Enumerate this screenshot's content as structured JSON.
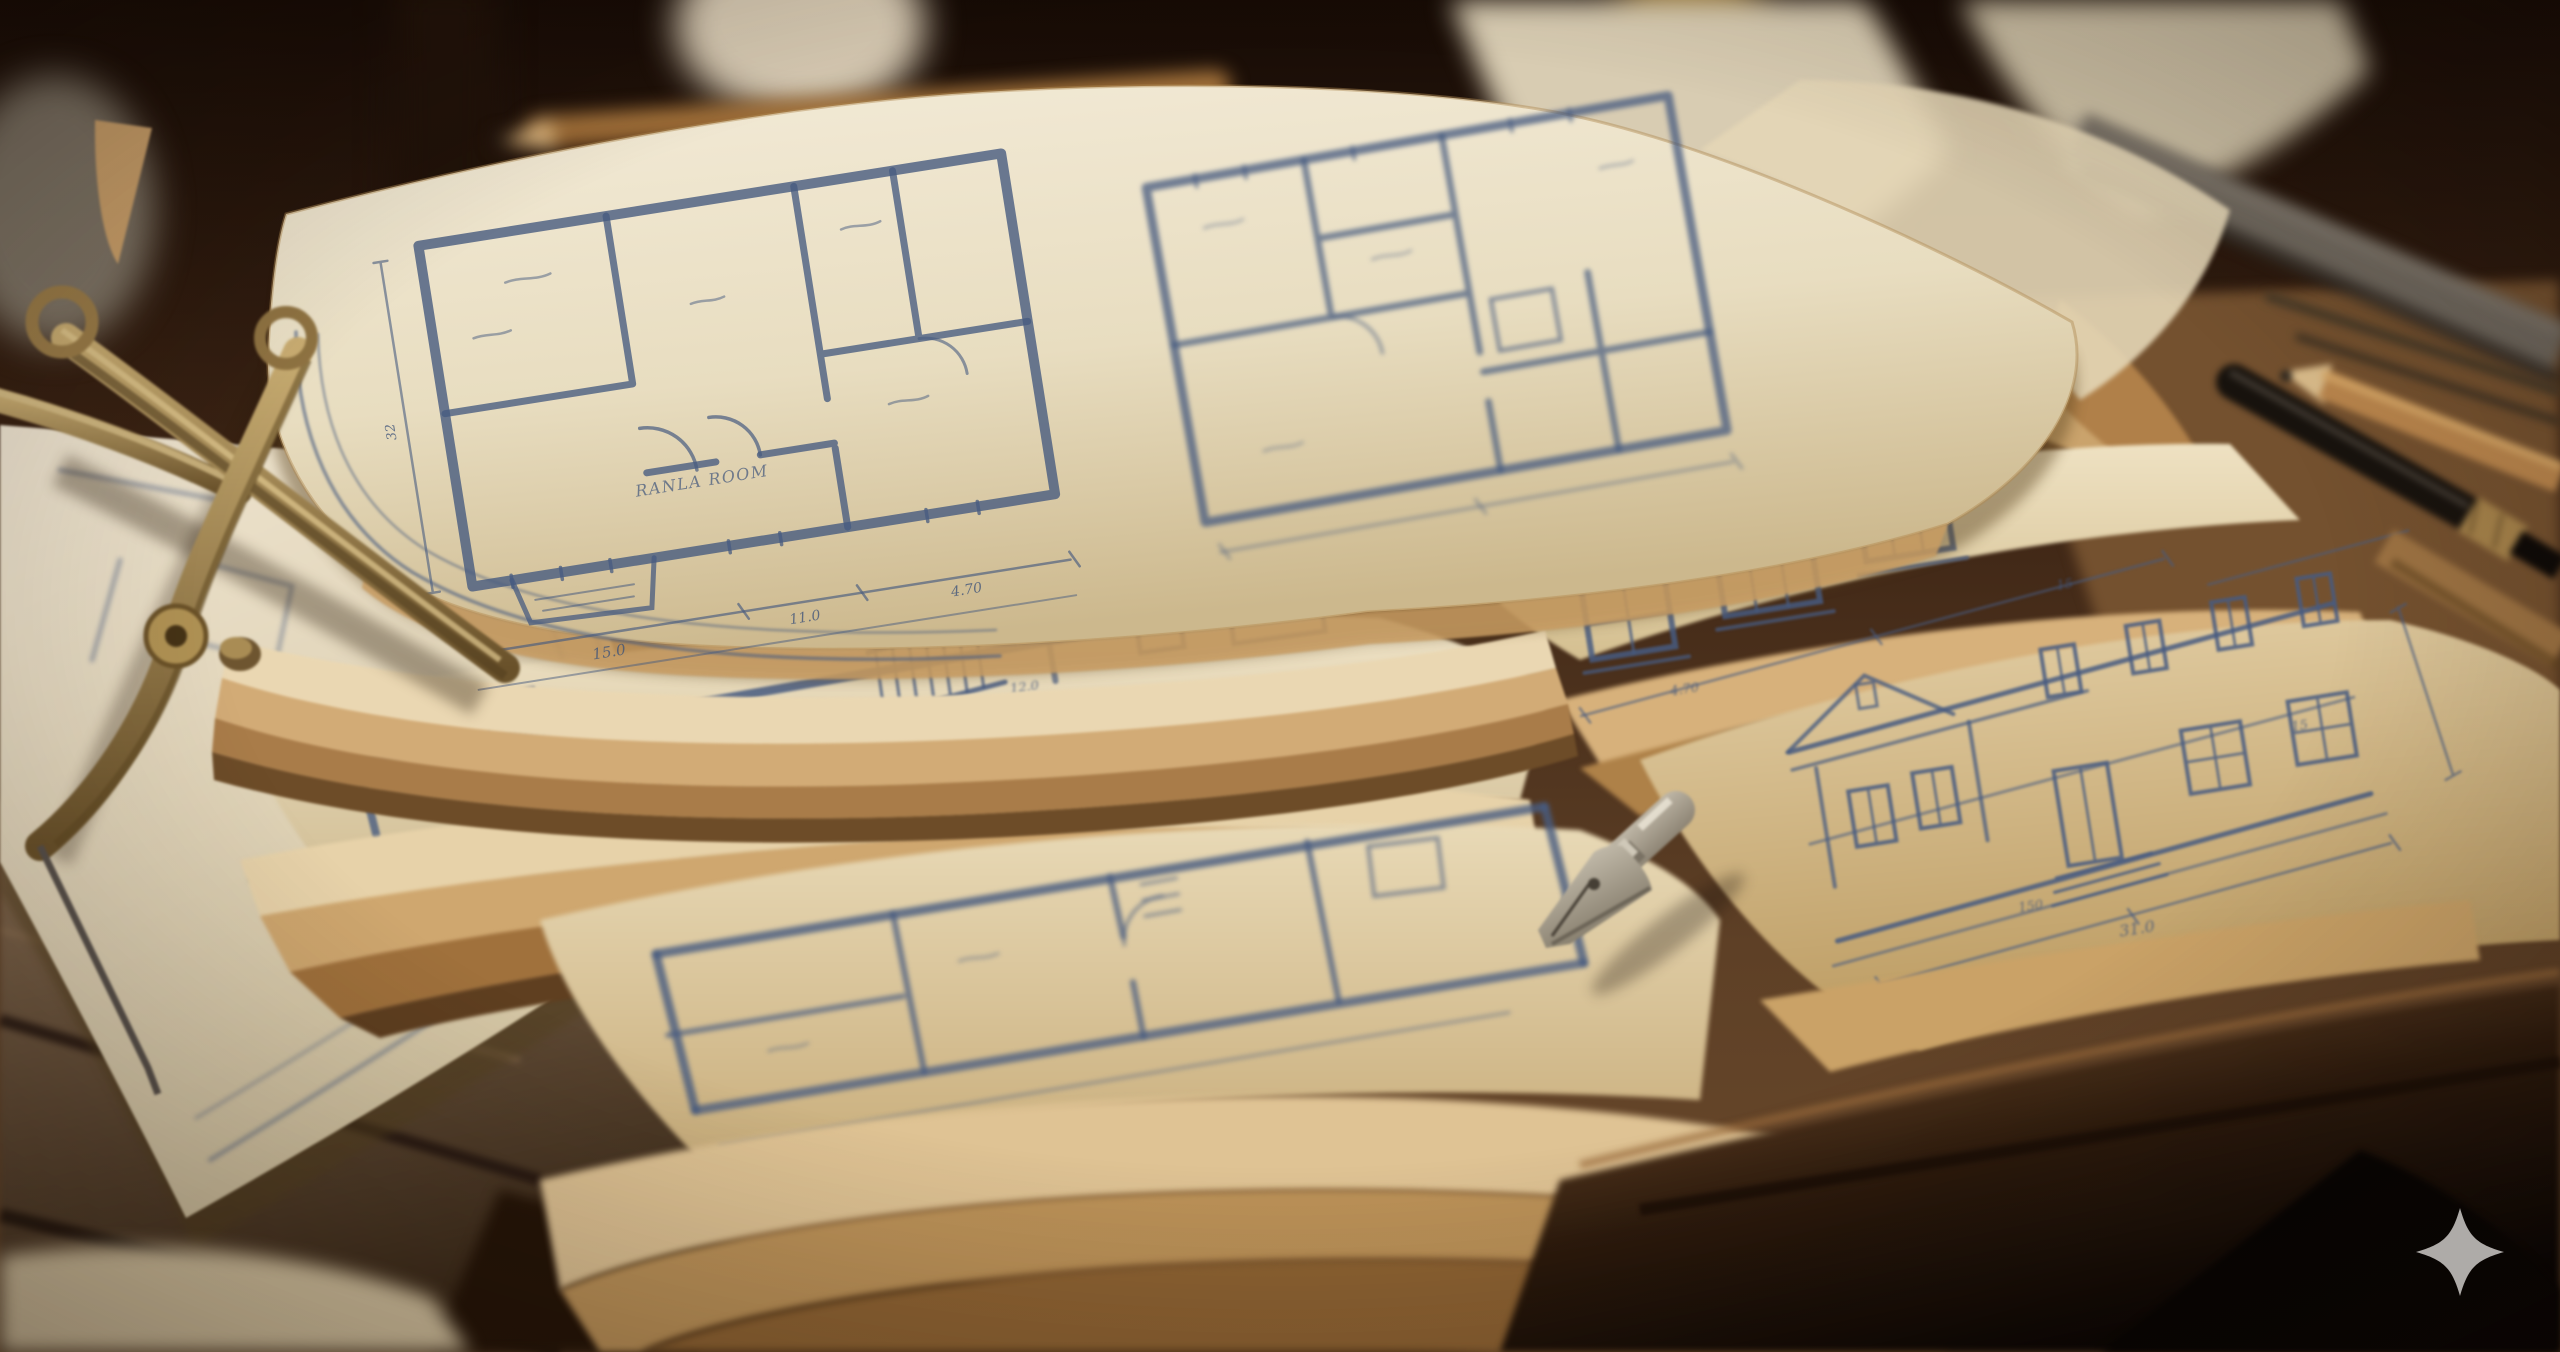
{
  "scene": {
    "type": "photograph",
    "description": "Stack of vintage hand-drawn architectural blueprint sheets with curled aged edges on a dark wooden drafting desk, with brass dividers, a steel dip-pen nib, pencils, a black pen and a blurred metal ruler; gray sparkle watermark at bottom right",
    "objects": [
      "top-sheet-two-floor-plans",
      "second-sheet-staircase-plan",
      "windows-elevation-strip-sheet",
      "bottom-floor-plan-sheet",
      "house-facade-elevation-sheet",
      "left-flat-sheet",
      "brass-divider-compass",
      "steel-pen-nib",
      "black-pen",
      "wooden-pencils",
      "metal-ruler",
      "wooden-desk",
      "sparkle-watermark"
    ],
    "watermark_icon": "sparkle-icon"
  },
  "labels": {
    "room_top": "RANLA ROOM",
    "plans_room": "PLANS ROOM",
    "architect": "A. A. BROWN",
    "dim_a": "15.0",
    "dim_b": "4.70",
    "dim_c": "11.0",
    "dim_d": "32",
    "dim_e": "31.0",
    "dim_f": "15",
    "dim_g": "8.0",
    "dim_h": "150",
    "dim_i": "12.0"
  },
  "palette": {
    "wood_dark": "#160b05",
    "wood_mid": "#3c2414",
    "wood_warm": "#6b4a2c",
    "paper_cream": "#f3ebd8",
    "paper_mid": "#e8ddc0",
    "paper_shadowed": "#ccb88d",
    "paper_edge_tan": "#d2ab76",
    "paper_edge_deep": "#a0713c",
    "ink_blue": "#475b80",
    "ink_blue_dark": "#3f547a",
    "brass": "#c9ad72",
    "brass_dark": "#69512a",
    "steel_nib": "#ddd6c6",
    "watermark_gray": "#b7b4b1"
  }
}
